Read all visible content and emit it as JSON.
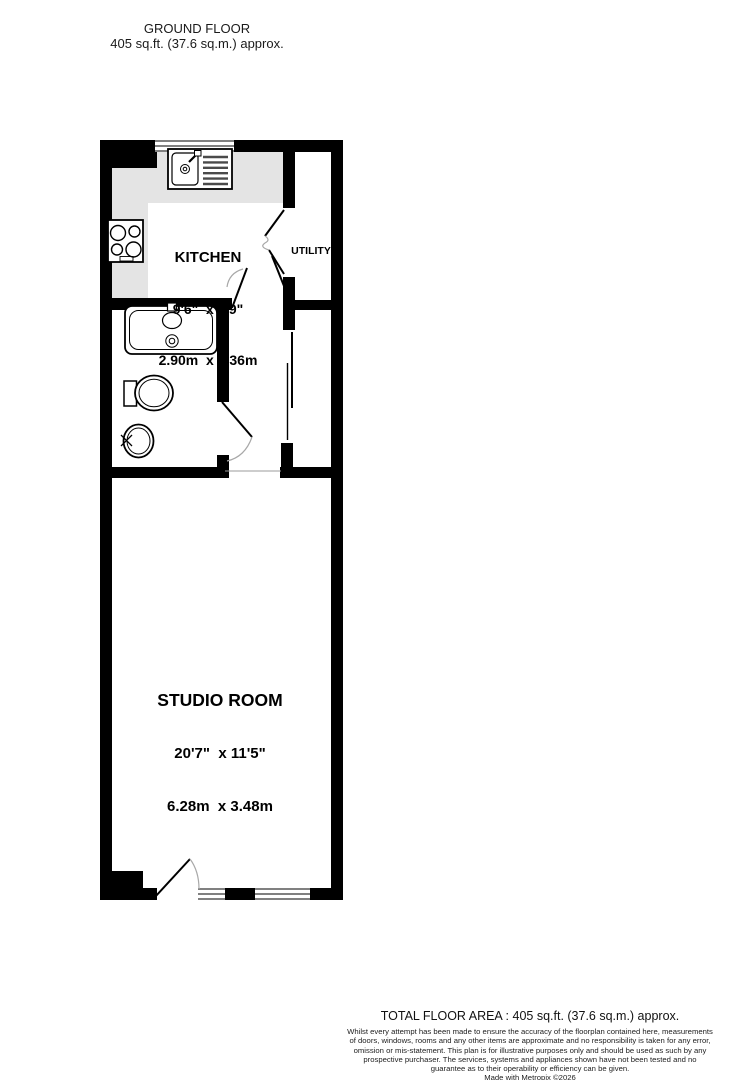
{
  "header": {
    "title": "GROUND FLOOR",
    "area": "405 sq.ft. (37.6 sq.m.) approx."
  },
  "rooms": [
    {
      "name": "KITCHEN",
      "imperial": "9'6\"  x 7'9\"",
      "metric": "2.90m  x 2.36m"
    },
    {
      "name": "UTILITY"
    },
    {
      "name": "STUDIO ROOM",
      "imperial": "20'7\"  x 11'5\"",
      "metric": "6.28m  x 3.48m"
    }
  ],
  "fixtures": [
    "kitchen-sink",
    "hob",
    "bathtub",
    "toilet",
    "wash-basin"
  ],
  "features": [
    "window-kitchen-top",
    "window-studio-left",
    "window-studio-right",
    "door-kitchen",
    "door-utility-bifold",
    "door-bathroom",
    "door-studio-entry",
    "sliding-door-cupboard"
  ],
  "footer": {
    "total": "TOTAL FLOOR AREA : 405 sq.ft. (37.6 sq.m.) approx.",
    "disclaimer": "Whilst every attempt has been made to ensure the accuracy of the floorplan contained here, measurements of doors, windows, rooms and any other items are approximate and no responsibility is taken for any error, omission or mis-statement. This plan is for illustrative purposes only and should be used as such by any prospective purchaser. The services, systems and appliances shown have not been tested and no guarantee as to their operability or efficiency can be given.",
    "credit": "Made with Metropix ©2026"
  },
  "colors": {
    "wall": "#000000",
    "counter": "#e4e4e4",
    "background": "#ffffff",
    "door_arc": "#a8a8a8"
  }
}
